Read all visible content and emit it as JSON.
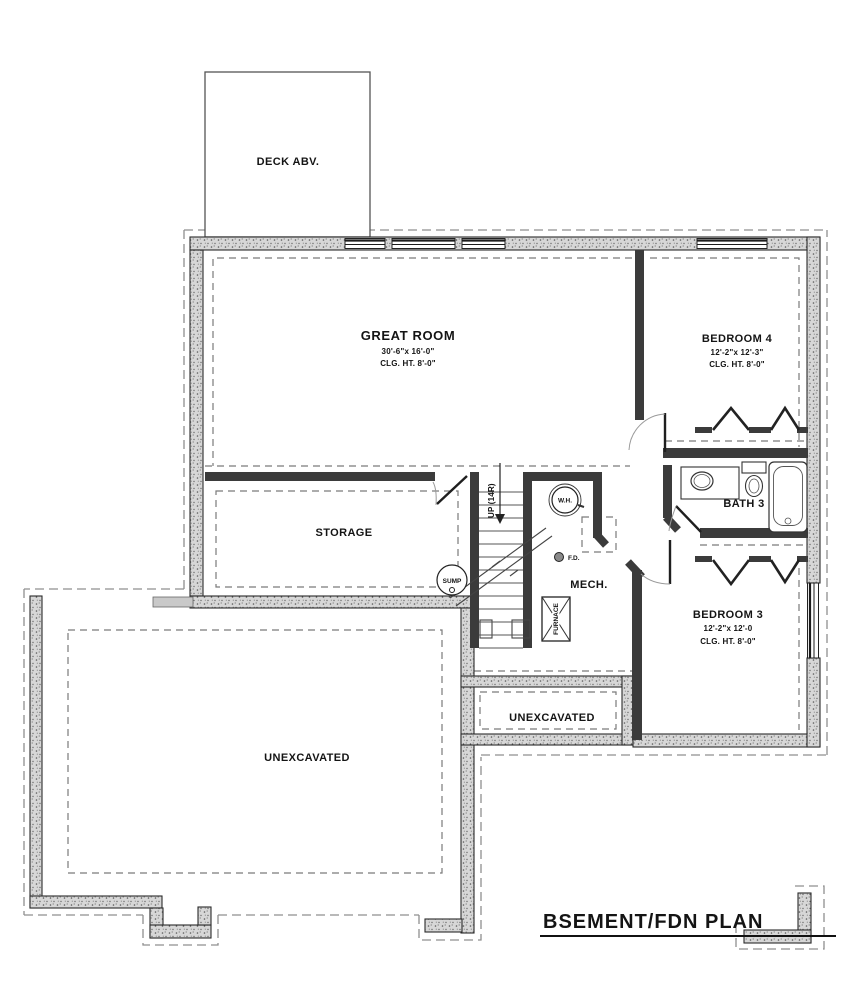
{
  "title": {
    "text": "BSEMENT/FDN PLAN"
  },
  "rooms": {
    "deck": {
      "label": "DECK ABV."
    },
    "great_room": {
      "name": "GREAT ROOM",
      "dims": "30'-6\"x 16'-0\"",
      "ceiling": "CLG. HT. 8'-0\""
    },
    "bedroom4": {
      "name": "BEDROOM 4",
      "dims": "12'-2\"x 12'-3\"",
      "ceiling": "CLG. HT. 8'-0\""
    },
    "bedroom3": {
      "name": "BEDROOM 3",
      "dims": "12'-2\"x 12'-0",
      "ceiling": "CLG. HT. 8'-0\""
    },
    "storage": {
      "name": "STORAGE"
    },
    "bath3": {
      "name": "BATH 3"
    },
    "mech": {
      "name": "MECH."
    },
    "unexcavated_center": {
      "name": "UNEXCAVATED"
    },
    "unexcavated_garage": {
      "name": "UNEXCAVATED"
    }
  },
  "annotations": {
    "stairs_up": "UP (14R)",
    "water_heater": "W.H.",
    "floor_drain": "F.D.",
    "sump": "SUMP",
    "furnace": "FURNACE"
  },
  "colors": {
    "wall_dark": "#3b3b3b",
    "dashed_line": "#8f8f8f",
    "paper": "#ffffff"
  }
}
